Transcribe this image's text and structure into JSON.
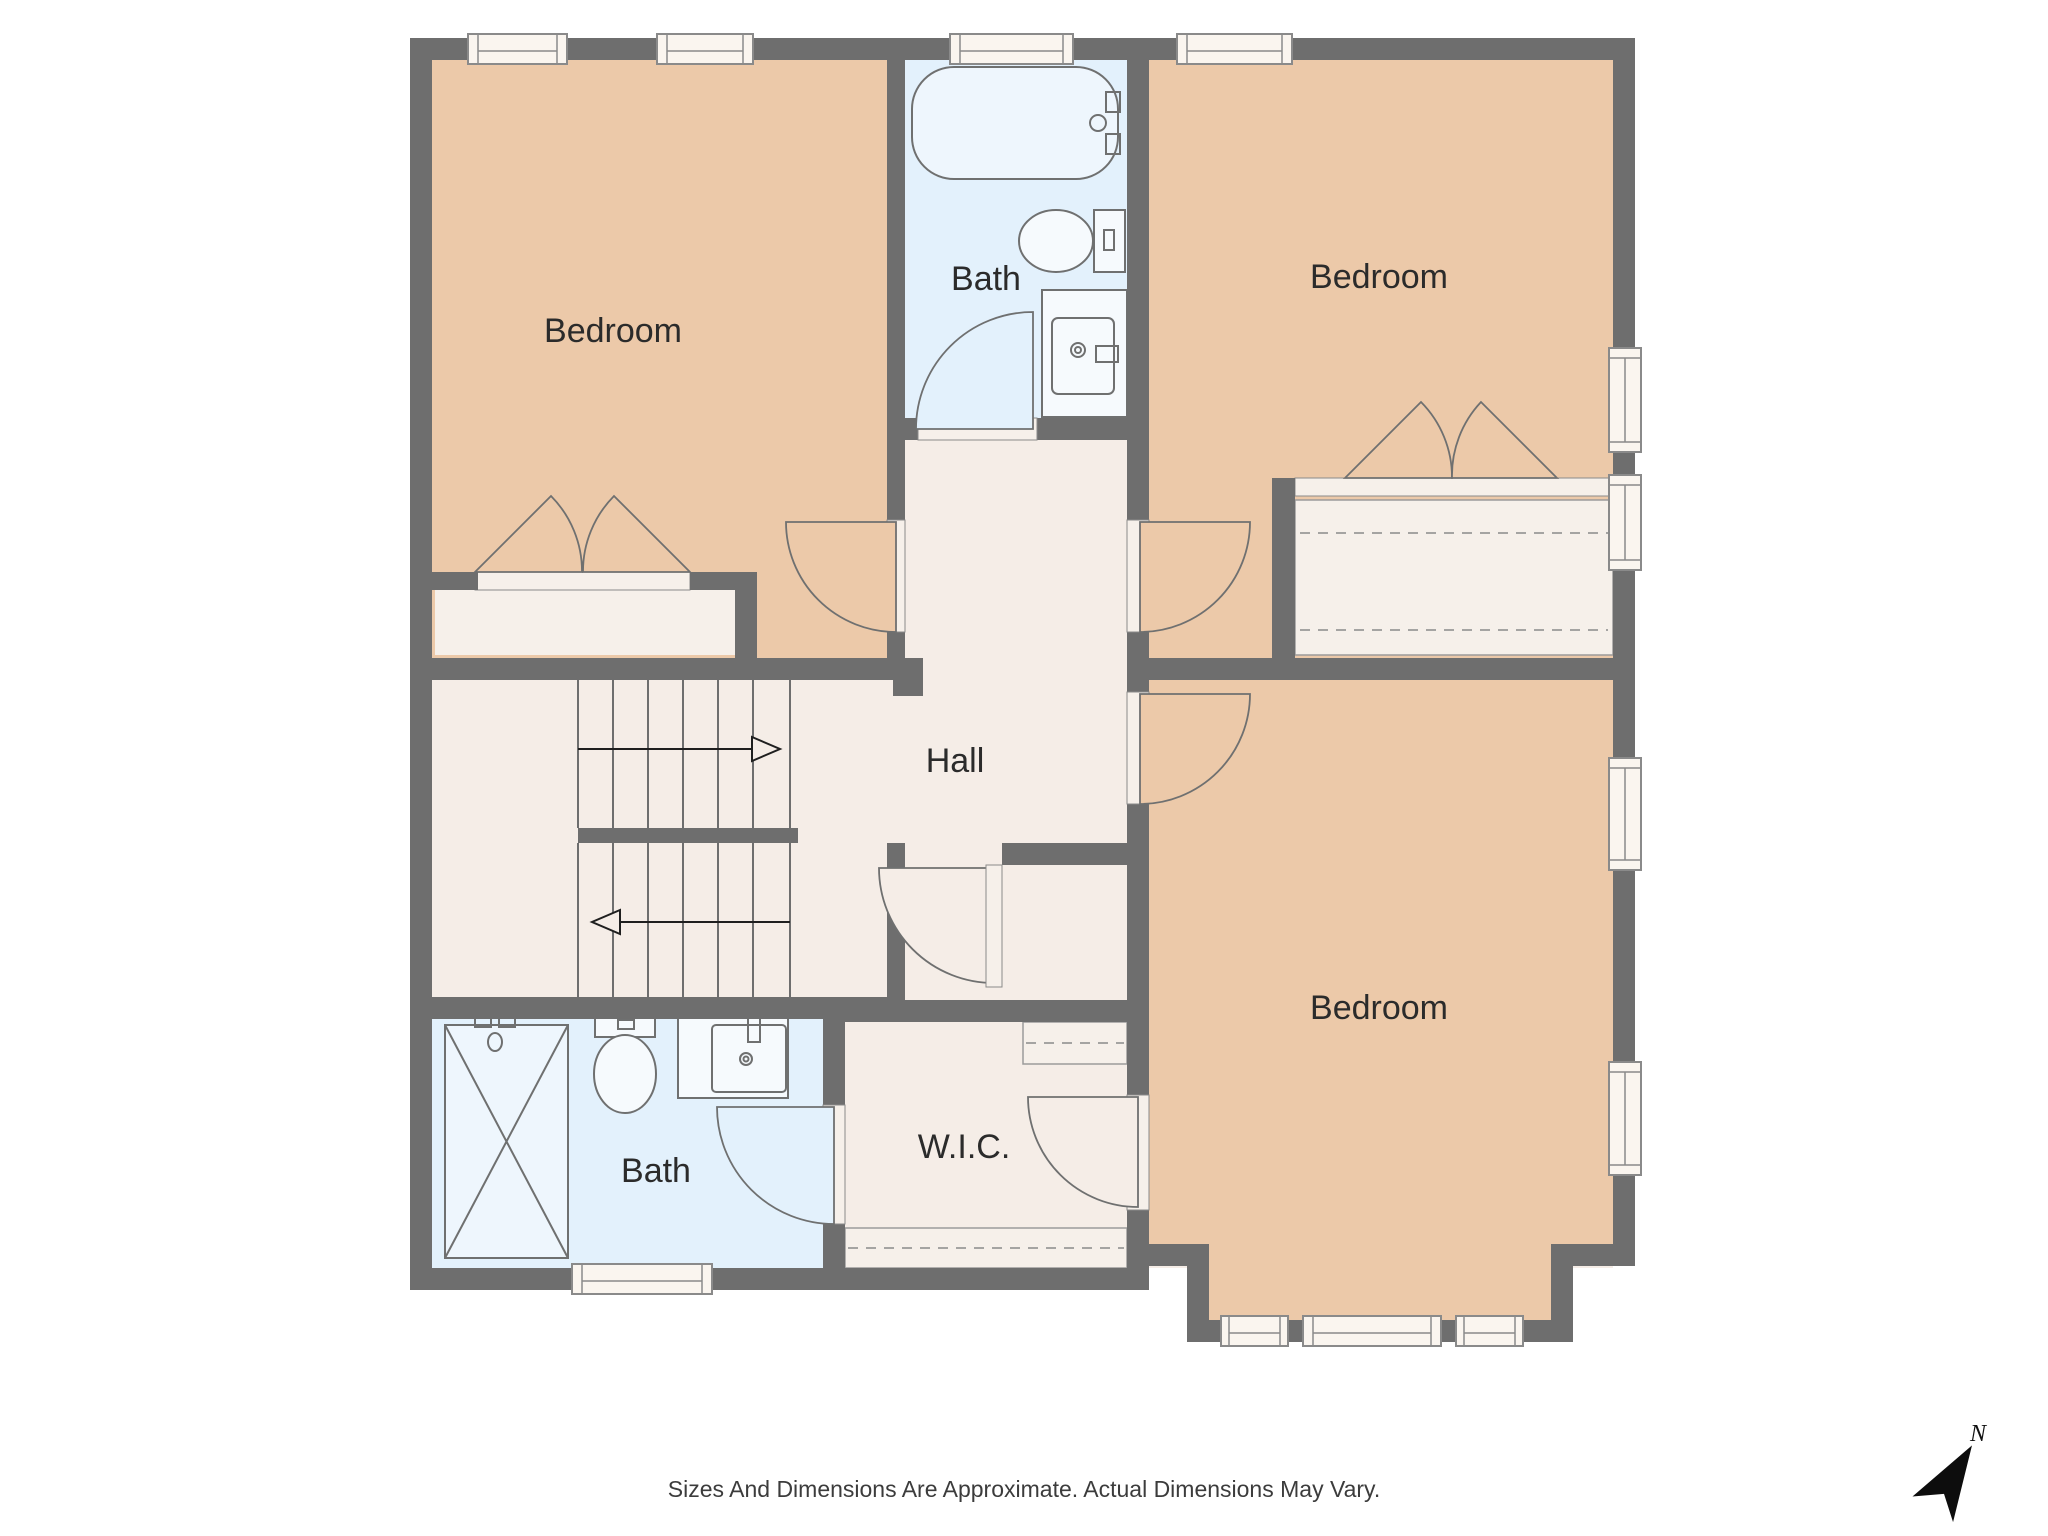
{
  "floor_plan": {
    "rooms": [
      {
        "id": "bedroom-top-left",
        "label": "Bedroom"
      },
      {
        "id": "bath-top",
        "label": "Bath"
      },
      {
        "id": "bedroom-top-right",
        "label": "Bedroom"
      },
      {
        "id": "hall",
        "label": "Hall"
      },
      {
        "id": "bedroom-bottom-right",
        "label": "Bedroom"
      },
      {
        "id": "bath-bottom",
        "label": "Bath"
      },
      {
        "id": "walk-in-closet",
        "label": "W.I.C."
      }
    ],
    "compass": {
      "north_label": "N"
    },
    "disclaimer": "Sizes And Dimensions Are Approximate. Actual Dimensions May Vary.",
    "colors": {
      "wall": "#6e6e6e",
      "bedroom": "#ecc9a9",
      "bath": "#e3f1fc",
      "hall": "#f5ede7",
      "fixwhite": "#f6f0ea",
      "stroke": "#6f7070",
      "text": "#2b2b2b"
    }
  }
}
